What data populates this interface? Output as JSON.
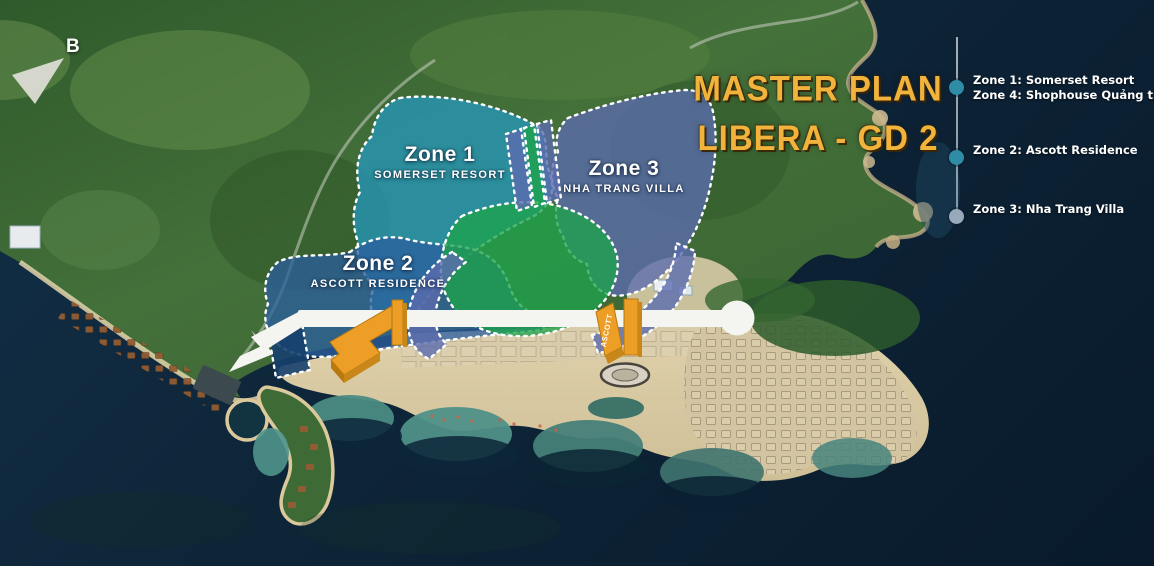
{
  "map": {
    "title_line1": "MASTER PLAN",
    "title_line2": "LIBERA - GD 2",
    "compass_label": "B",
    "zone_labels": [
      {
        "id": "zone1",
        "title": "Zone 1",
        "subtitle": "SOMERSET RESORT"
      },
      {
        "id": "zone2",
        "title": "Zone 2",
        "subtitle": "ASCOTT RESIDENCE"
      },
      {
        "id": "zone3",
        "title": "Zone 3",
        "subtitle": "NHA TRANG VILLA"
      }
    ],
    "tower_label": "ASCOTT"
  },
  "legend": {
    "items": [
      {
        "lines": [
          "Zone 1: Somerset Resort",
          "Zone 4: Shophouse Quảng trường"
        ],
        "dot_color": "#2E8CA6"
      },
      {
        "lines": [
          "Zone 2: Ascott Residence"
        ],
        "dot_color": "#2E8CA6"
      },
      {
        "lines": [
          "Zone 3: Nha Trang Villa"
        ],
        "dot_color": "#97A9BB"
      }
    ]
  },
  "colors": {
    "title_yellow": "#F2B33C",
    "legend_dot_teal": "#2E8CA6",
    "legend_dot_gray": "#97A9BB",
    "zone1_fill": "#2498C0",
    "zone2_fill": "#2B5F9E",
    "zone3_fill": "#5B6CAE",
    "park_green_fill": "#1DA34C",
    "building_orange": "#E8951F",
    "road_white": "#F4F4F1",
    "ocean_dark": "#0B2236",
    "label_white": "#FFFFFF"
  }
}
